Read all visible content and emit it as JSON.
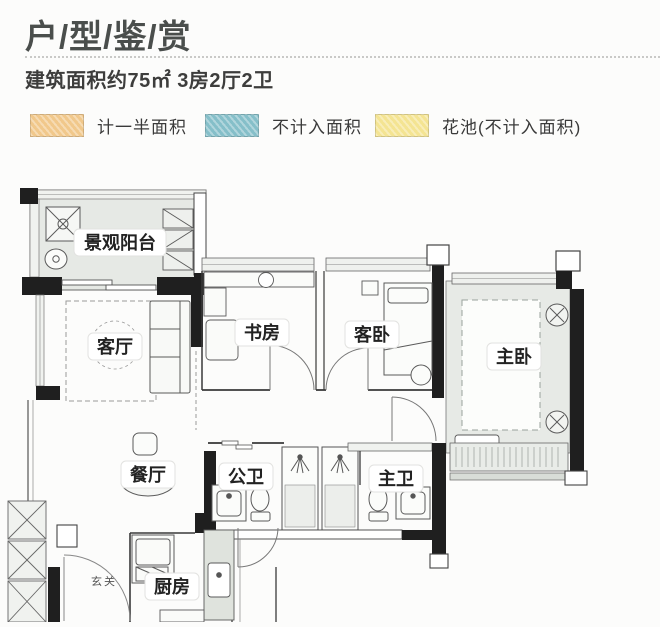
{
  "header": {
    "title": "户/型/鉴/赏",
    "subtitle": "建筑面积约75㎡ 3房2厅2卫"
  },
  "legend": {
    "items": [
      {
        "label": "计一半面积",
        "color": "#f1c88b"
      },
      {
        "label": "不计入面积",
        "color": "#85bfc9"
      },
      {
        "label": "花池(不计入面积)",
        "color": "#f4e492"
      }
    ]
  },
  "colors": {
    "title_text": "#4a4e4c",
    "wall": "#1f1f1f",
    "tinted_area": "#e7eae6"
  },
  "floorplan": {
    "rooms": [
      {
        "id": "balcony",
        "label": "景观阳台"
      },
      {
        "id": "living-room",
        "label": "客厅"
      },
      {
        "id": "study",
        "label": "书房"
      },
      {
        "id": "guest-bedroom",
        "label": "客卧"
      },
      {
        "id": "master-bedroom",
        "label": "主卧"
      },
      {
        "id": "dining-room",
        "label": "餐厅"
      },
      {
        "id": "public-bathroom",
        "label": "公卫"
      },
      {
        "id": "master-bathroom",
        "label": "主卫"
      },
      {
        "id": "kitchen",
        "label": "厨房"
      },
      {
        "id": "entry",
        "label": "玄关"
      }
    ]
  }
}
